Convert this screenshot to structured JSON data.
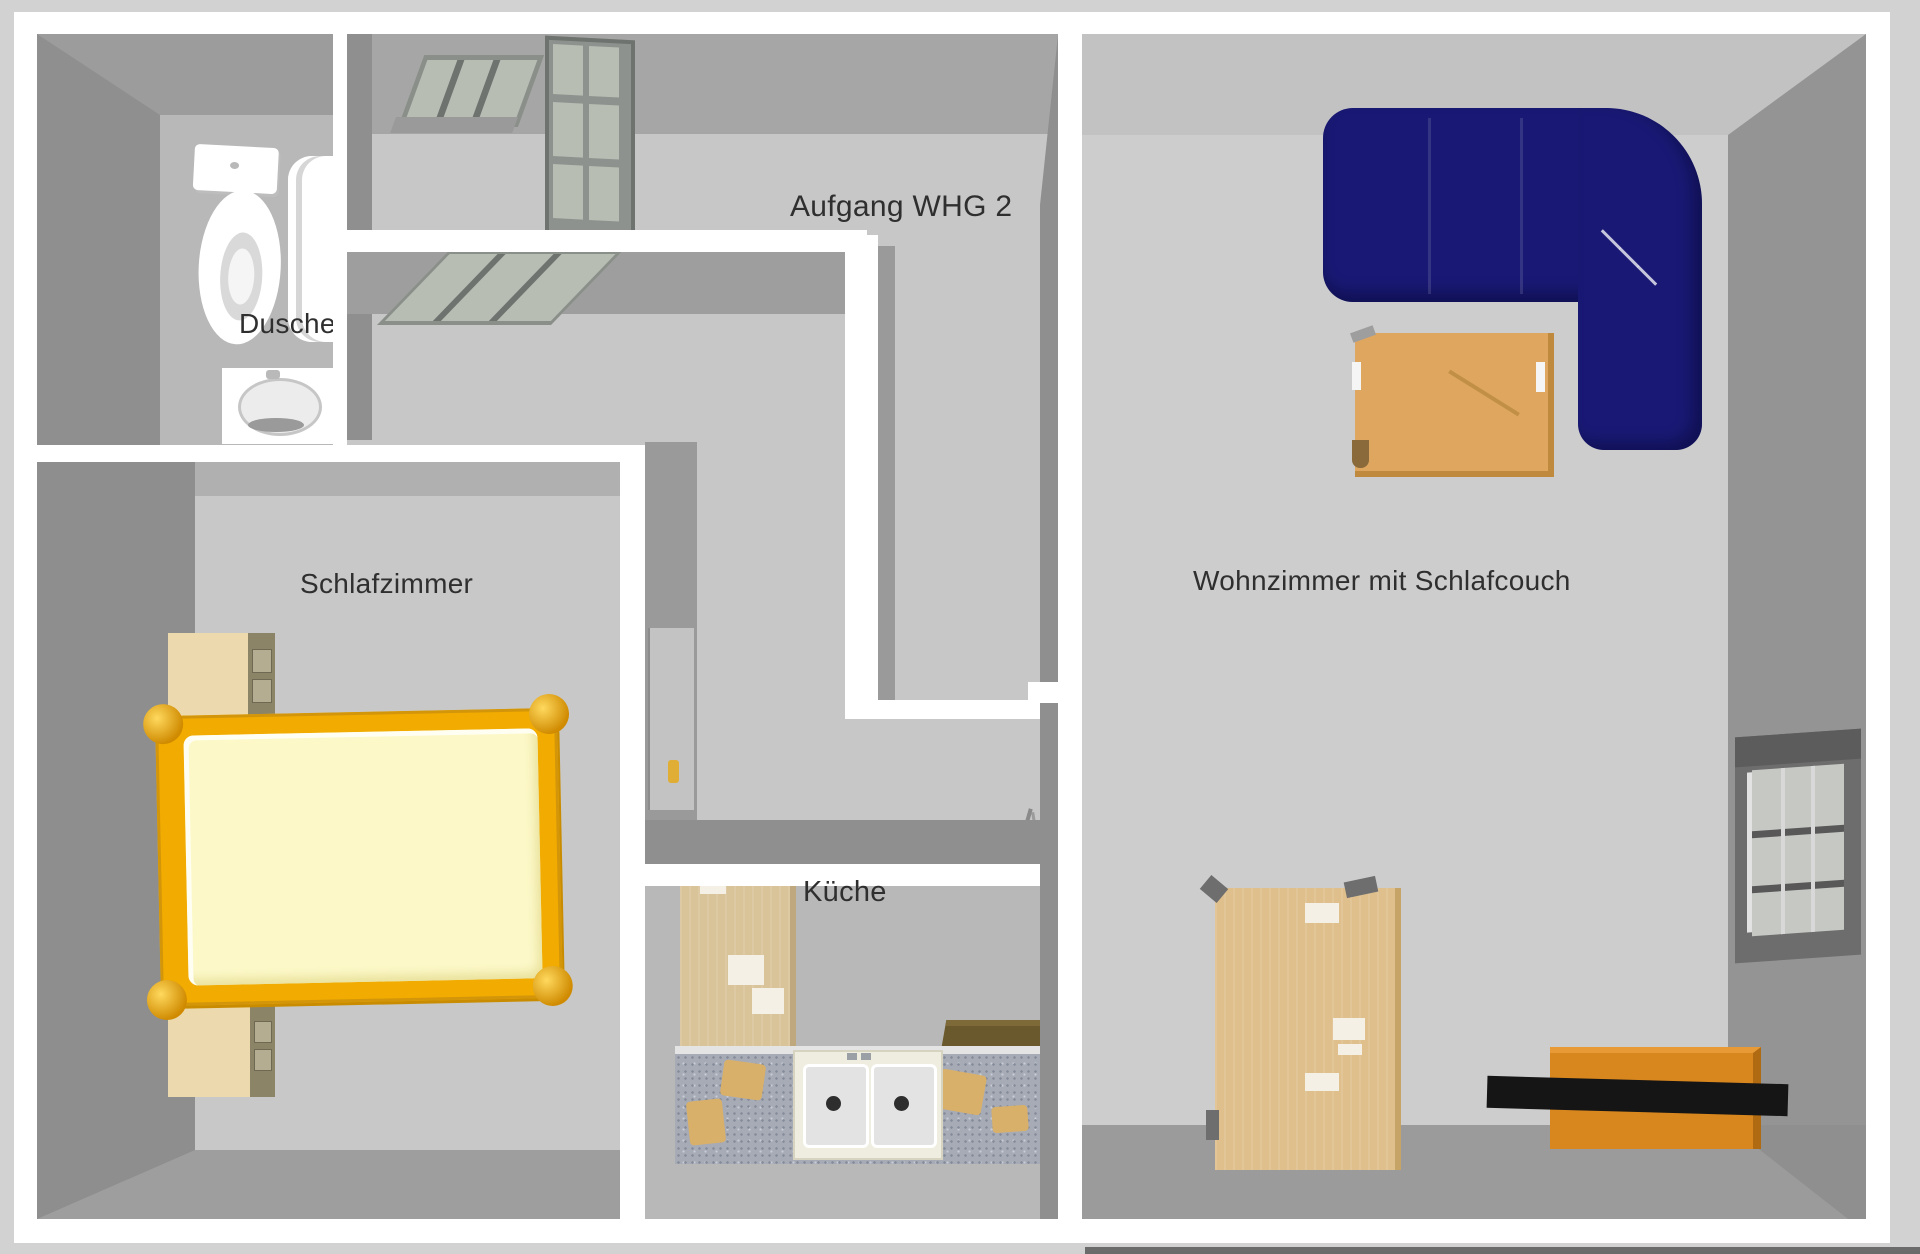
{
  "view": {
    "type": "3d-floor-plan",
    "width_px": 1920,
    "height_px": 1254
  },
  "rooms": {
    "bathroom": {
      "label": "Dusche"
    },
    "stairway": {
      "label": "Aufgang WHG 2"
    },
    "bedroom": {
      "label": "Schlafzimmer"
    },
    "kitchen": {
      "label": "Küche"
    },
    "living_room": {
      "label": "Wohnzimmer mit Schlafcouch"
    }
  },
  "colors": {
    "background": "#d2d2d2",
    "wall": "#ffffff",
    "wall_face_dark": "#8f8f8f",
    "wall_face_mid": "#9e9e9e",
    "floor": "#c7c7c7",
    "floor_light": "#cdcdcd",
    "floor_kitchen": "#b8b8b8",
    "sofa": "#191975",
    "bed_frame": "#f2ab00",
    "bed_post": "#cf8a00",
    "mattress": "#fcf8c8",
    "wood_cabinet": "#d9c49a",
    "wood_nightstand": "#ecd9ad",
    "wood_side_dark": "#8c8466",
    "coffee_table": "#dfa660",
    "wardrobe": "#dfc08c",
    "sideboard_orange": "#d8861e",
    "shelf_black": "#151515",
    "counter": "#a6abb6",
    "counter_item_tan": "#d9b06a",
    "stove_brown": "#6a592c",
    "skylight_glass": "#b7bdb3",
    "window_glass": "#c5c8c3",
    "window_frame": "#6d6d6d",
    "door_handle_yellow": "#e0ae35",
    "label_text": "#2f2f2f"
  }
}
